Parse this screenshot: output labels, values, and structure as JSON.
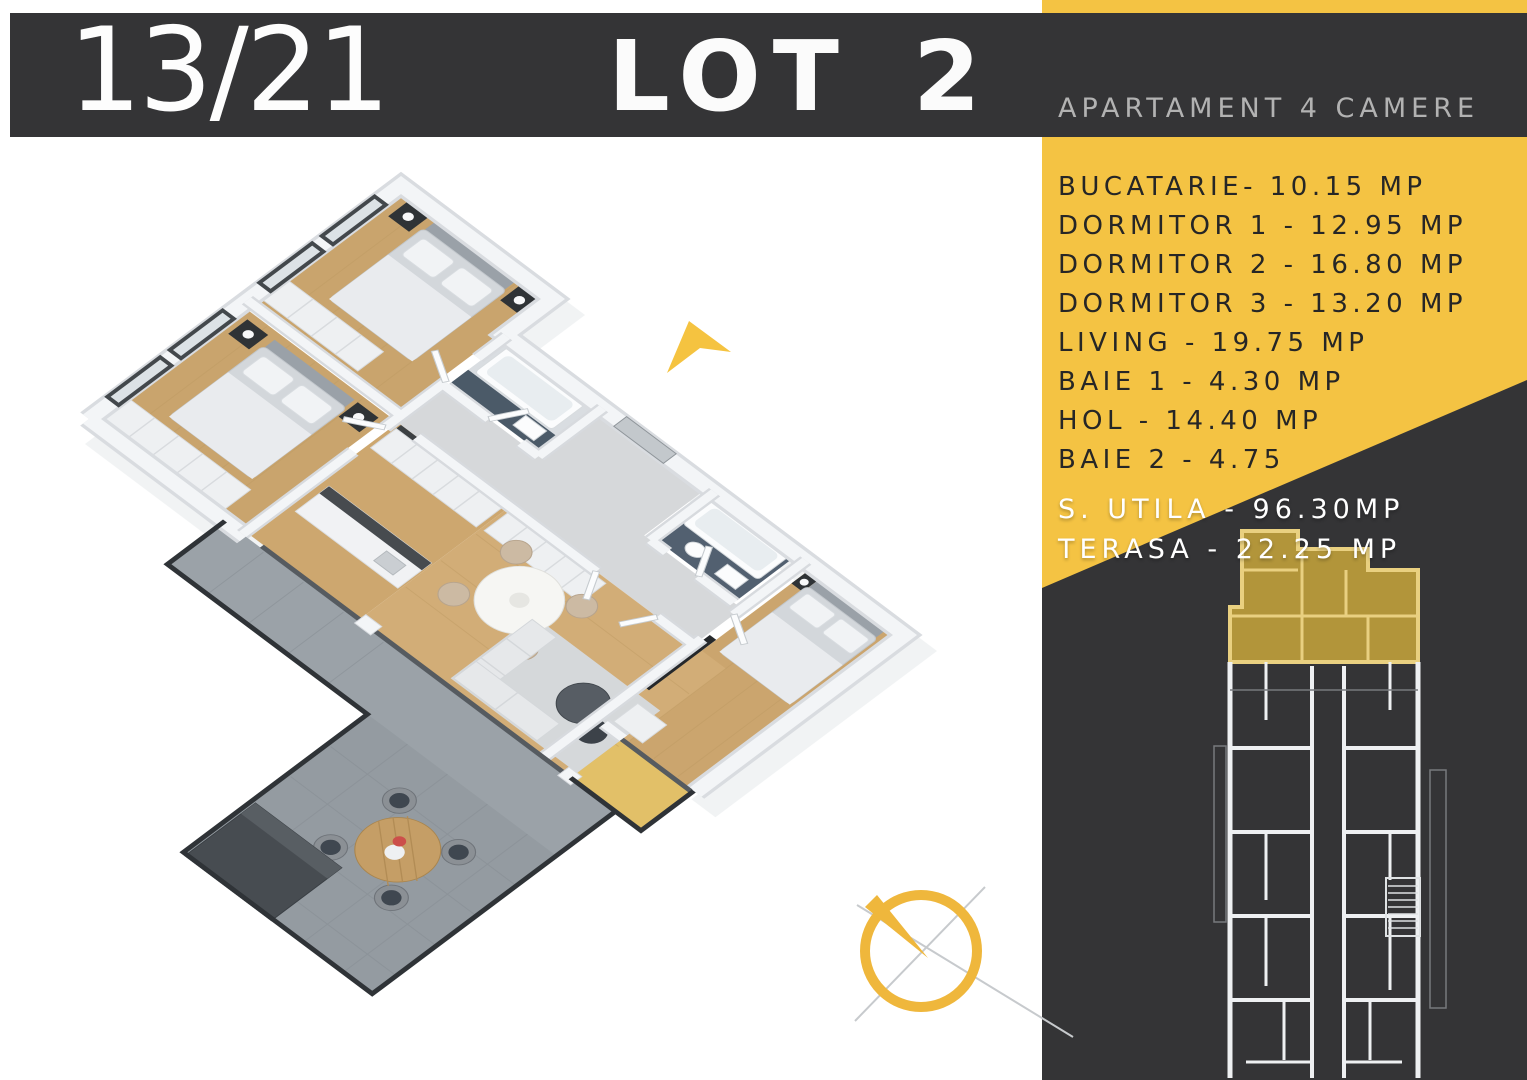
{
  "header": {
    "page_number": "13/21",
    "lot_label": "LOT",
    "lot_number": "2",
    "subtitle": "APARTAMENT 4 CAMERE",
    "bar_color": "#343436"
  },
  "sidebar": {
    "accent_color": "#F4C343",
    "panel_dark_color": "#343436",
    "room_list": [
      "BUCATARIE- 10.15 MP",
      "DORMITOR 1 - 12.95 MP",
      "DORMITOR 2 - 16.80 MP",
      "DORMITOR 3 - 13.20 MP",
      "LIVING - 19.75 MP",
      "BAIE 1 - 4.30 MP",
      "HOL - 14.40 MP",
      "BAIE 2 - 4.75"
    ],
    "summary": [
      "S. UTILA - 96.30MP",
      "TERASA - 22.25 MP"
    ]
  },
  "floor_plan": {
    "style": "isometric 3d apartment render",
    "wood_floor_color": "#cda76f",
    "hall_floor_color": "#d6d8da",
    "terrace_floor_color": "#9ba2a8",
    "wall_color": "#f3f5f7"
  },
  "icons": {
    "north_arrow_color": "#F5C340",
    "compass_ring_color": "#EFB73C"
  },
  "inset": {
    "highlight_fill": "#B2953A",
    "highlight_wall": "#E9D080",
    "building_line_color": "#EEF0F2"
  }
}
